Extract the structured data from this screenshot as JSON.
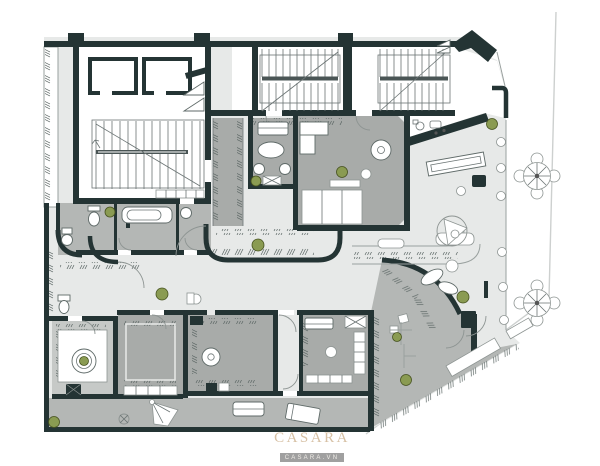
{
  "watermark": {
    "brand": "CASARA",
    "site": "CASARA.VN"
  },
  "colors": {
    "page_bg": "#ffffff",
    "wall": "#243434",
    "slab": "#e7e9e8",
    "room": "#a8aba9",
    "room2": "#b4b7b5",
    "room_light": "#c6c9c7",
    "plant": "#8a9b52",
    "boundary": "#cdd0cf",
    "line": "#6b7474",
    "logo_tan": "#d7c1a5",
    "logo_box": "#a0a0a0",
    "logo_box_text": "#efece7"
  }
}
